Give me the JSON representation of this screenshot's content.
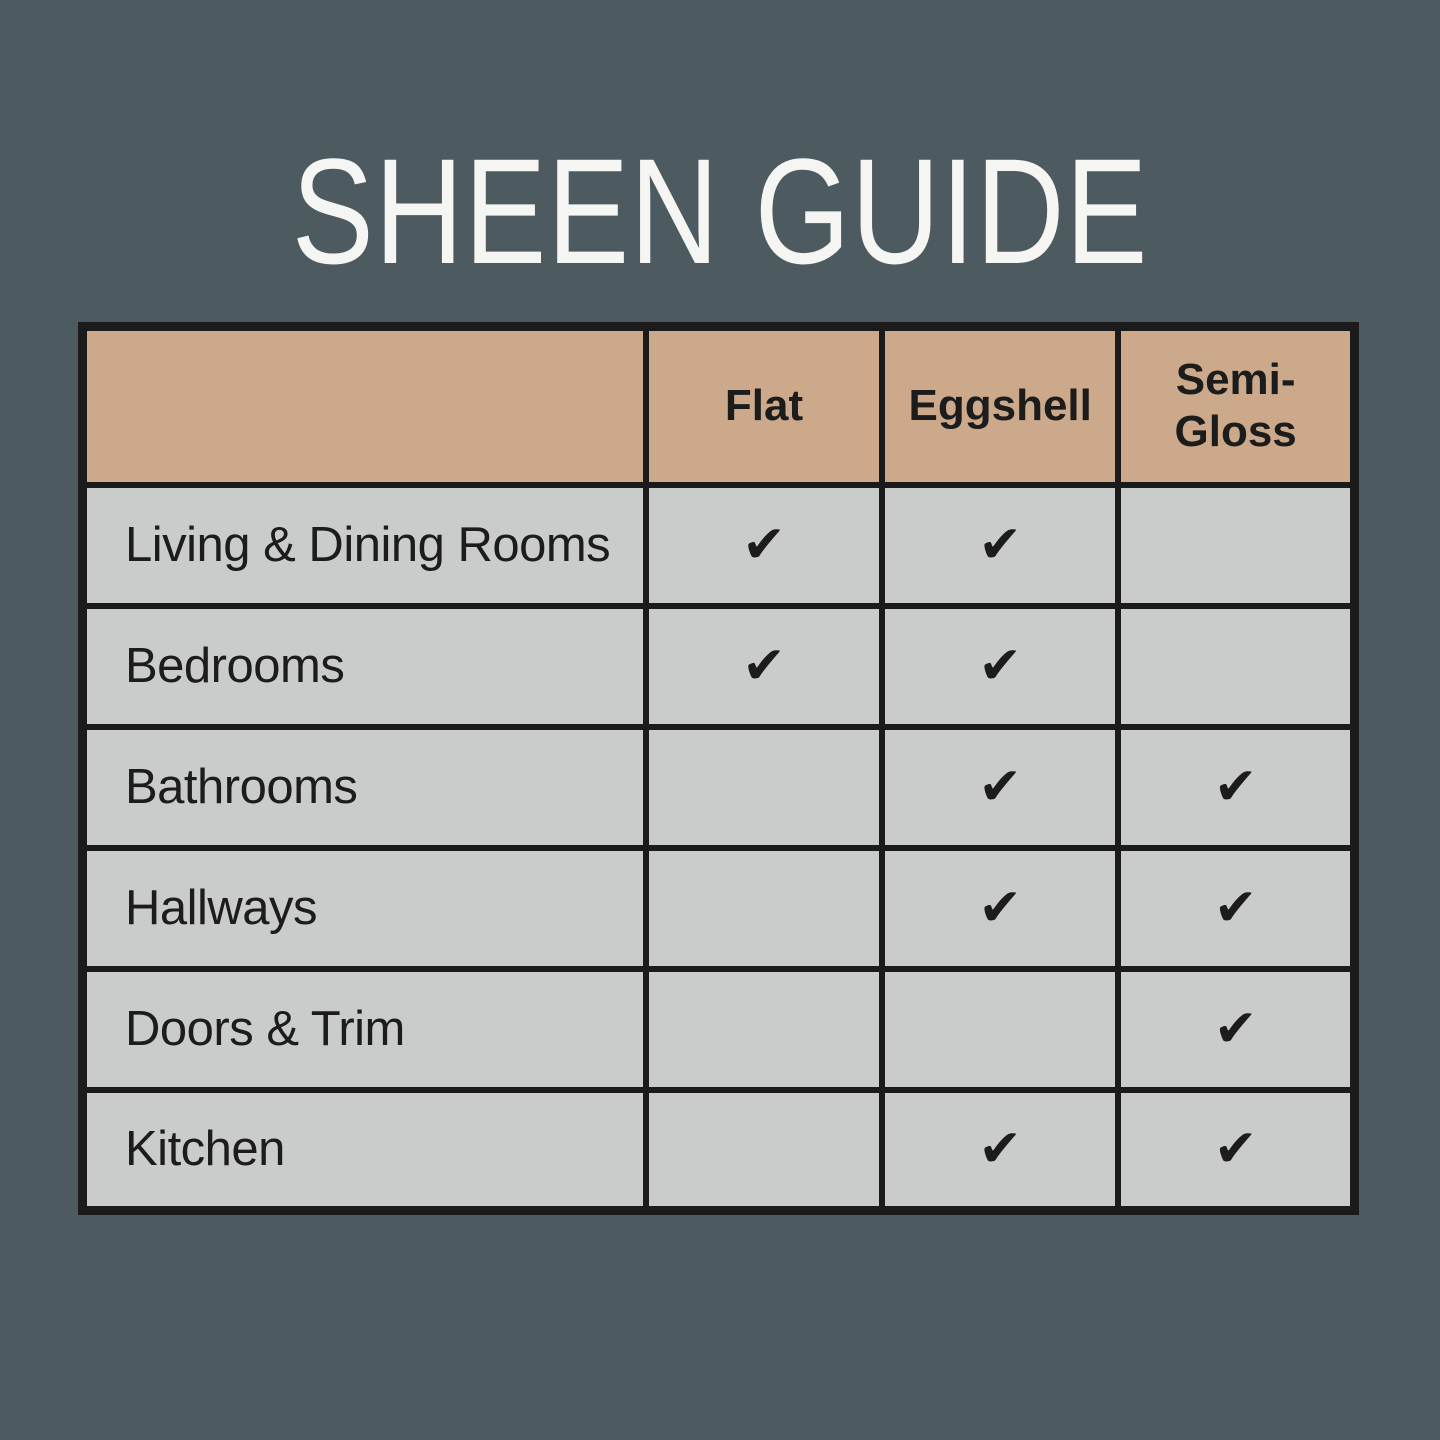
{
  "page": {
    "title": "SHEEN GUIDE"
  },
  "colors": {
    "background": "#4d5b61",
    "header_bg": "#cba98a",
    "row_bg": "#cacccb",
    "grid_border": "#1b1b1b",
    "title_text": "#f5f5f3",
    "table_text": "#1c1c1c"
  },
  "table": {
    "headers": [
      "",
      "Flat",
      "Eggshell",
      "Semi-Gloss"
    ],
    "check_glyph": "✔",
    "rows": [
      {
        "label": "Living & Dining Rooms",
        "cells": [
          "✔",
          "✔",
          ""
        ]
      },
      {
        "label": "Bedrooms",
        "cells": [
          "✔",
          "✔",
          ""
        ]
      },
      {
        "label": "Bathrooms",
        "cells": [
          "",
          "✔",
          "✔"
        ]
      },
      {
        "label": "Hallways",
        "cells": [
          "",
          "✔",
          "✔"
        ]
      },
      {
        "label": "Doors & Trim",
        "cells": [
          "",
          "",
          "✔"
        ]
      },
      {
        "label": "Kitchen",
        "cells": [
          "",
          "✔",
          "✔"
        ]
      }
    ]
  },
  "chart_data": {
    "type": "table",
    "title": "SHEEN GUIDE",
    "columns": [
      "",
      "Flat",
      "Eggshell",
      "Semi-Gloss"
    ],
    "rows": [
      {
        "room": "Living & Dining Rooms",
        "flat": true,
        "eggshell": true,
        "semi_gloss": false
      },
      {
        "room": "Bedrooms",
        "flat": true,
        "eggshell": true,
        "semi_gloss": false
      },
      {
        "room": "Bathrooms",
        "flat": false,
        "eggshell": true,
        "semi_gloss": true
      },
      {
        "room": "Hallways",
        "flat": false,
        "eggshell": true,
        "semi_gloss": true
      },
      {
        "room": "Doors & Trim",
        "flat": false,
        "eggshell": false,
        "semi_gloss": true
      },
      {
        "room": "Kitchen",
        "flat": false,
        "eggshell": true,
        "semi_gloss": true
      }
    ],
    "legend_position": "none",
    "grid": true
  }
}
